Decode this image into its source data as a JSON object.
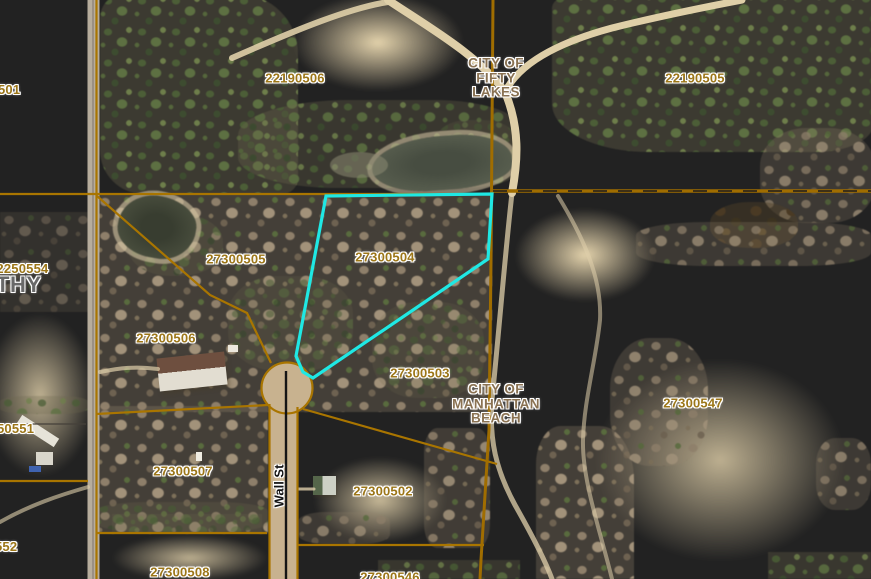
{
  "map": {
    "selected_parcel": "27300504",
    "colors": {
      "parcel_line": "#a97500",
      "city_boundary": "#a06d00",
      "selection_outline": "#1fe8e4",
      "parcel_label": "#9c7618",
      "city_label": "#8a7252",
      "street_label": "#141414",
      "township_label": "#696969"
    },
    "city_labels": [
      {
        "id": "fifty-lakes",
        "lines": [
          "CITY OF",
          "FIFTY",
          "LAKES"
        ]
      },
      {
        "id": "manhattan-beach",
        "lines": [
          "CITY OF",
          "MANHATTAN",
          "BEACH"
        ]
      }
    ],
    "parcel_labels": [
      {
        "id": "22190506",
        "text": "22190506"
      },
      {
        "id": "22190505",
        "text": "22190505"
      },
      {
        "id": "27300505",
        "text": "27300505"
      },
      {
        "id": "27300504",
        "text": "27300504"
      },
      {
        "id": "27300506",
        "text": "27300506"
      },
      {
        "id": "27300503",
        "text": "27300503"
      },
      {
        "id": "27300547",
        "text": "27300547"
      },
      {
        "id": "27300507",
        "text": "27300507"
      },
      {
        "id": "27300502",
        "text": "27300502"
      },
      {
        "id": "27300508",
        "text": "27300508"
      },
      {
        "id": "27300546",
        "text": "27300546"
      }
    ],
    "partial_labels": [
      {
        "id": "501",
        "text": "501"
      },
      {
        "id": "02250554",
        "text": "02250554"
      },
      {
        "id": "THY",
        "text": "THY"
      },
      {
        "id": "50551",
        "text": "50551"
      },
      {
        "id": "552",
        "text": "552"
      }
    ],
    "street_labels": [
      {
        "id": "wall-st",
        "text": "Wall St"
      }
    ]
  }
}
